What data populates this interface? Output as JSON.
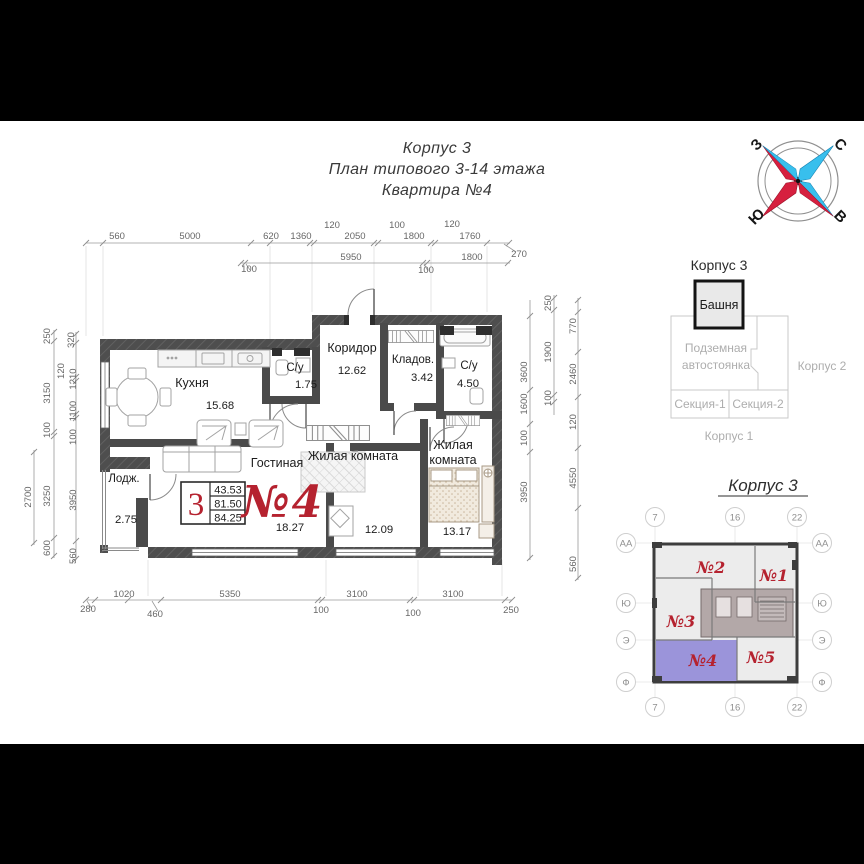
{
  "title": {
    "line1": "Корпус 3",
    "line2": "План типового 3-14 этажа",
    "line3": "Квартира №4"
  },
  "compass": {
    "n": "С",
    "e": "В",
    "s": "Ю",
    "w": "З"
  },
  "plan": {
    "rooms": {
      "kitchen": {
        "name": "Кухня",
        "area": "15.68"
      },
      "wc1": {
        "name": "С/у",
        "area": "1.75"
      },
      "corridor": {
        "name": "Коридор",
        "area": "12.62"
      },
      "storage": {
        "name": "Кладов.",
        "area": "3.42"
      },
      "wc2": {
        "name": "С/у",
        "area": "4.50"
      },
      "living": {
        "name": "Гостиная",
        "area": "18.27"
      },
      "bedroom1": {
        "name": "Жилая комната",
        "area": "12.09"
      },
      "bedroom2": {
        "name1": "Жилая",
        "name2": "комната",
        "area": "13.17"
      },
      "loggia": {
        "name": "Лодж.",
        "area": "2.75"
      }
    },
    "info": {
      "rooms_count": "3",
      "living_area": "43.53",
      "area": "81.50",
      "total_area": "84.25",
      "apartment_number": "№4"
    }
  },
  "dimensions": {
    "top_row1": [
      "560",
      "5000",
      "620",
      "1360",
      "120",
      "2050",
      "100",
      "1800",
      "120",
      "1760",
      "270"
    ],
    "top_row2": [
      "100",
      "5950",
      "100",
      "1800"
    ],
    "bottom": [
      "280",
      "1020",
      "460",
      "5350",
      "100",
      "3100",
      "100",
      "3100",
      "250"
    ],
    "left_col1": [
      "2700"
    ],
    "left_col2": [
      "250",
      "3150",
      "100",
      "3250",
      "600"
    ],
    "left_col3": [
      "320",
      "120",
      "1210",
      "1100",
      "100",
      "3950",
      "560"
    ],
    "right_col1": [
      "3600",
      "1600",
      "100",
      "3950"
    ],
    "right_col2": [
      "250",
      "1900",
      "100"
    ],
    "right_col3": [
      "770",
      "2460",
      "120",
      "4550",
      "560"
    ]
  },
  "key_plan": {
    "title": "Корпус 3",
    "tower": "Башня",
    "parking_line1": "Подземная",
    "parking_line2": "автостоянка",
    "korpus2": "Корпус 2",
    "section1": "Секция-1",
    "section2": "Секция-2",
    "korpus1": "Корпус 1"
  },
  "floor_plate": {
    "title": "Корпус 3",
    "apartments": [
      "№1",
      "№2",
      "№3",
      "№4",
      "№5"
    ],
    "axes_top": [
      "7",
      "16",
      "22"
    ],
    "axes_bottom": [
      "7",
      "16",
      "22"
    ],
    "axes_left": [
      "АА",
      "Ю",
      "Э",
      "Ф"
    ],
    "axes_right": [
      "АА",
      "Ю",
      "Э",
      "Ф"
    ],
    "highlight_color": "#9b94da",
    "accent_red": "#b5222f"
  }
}
